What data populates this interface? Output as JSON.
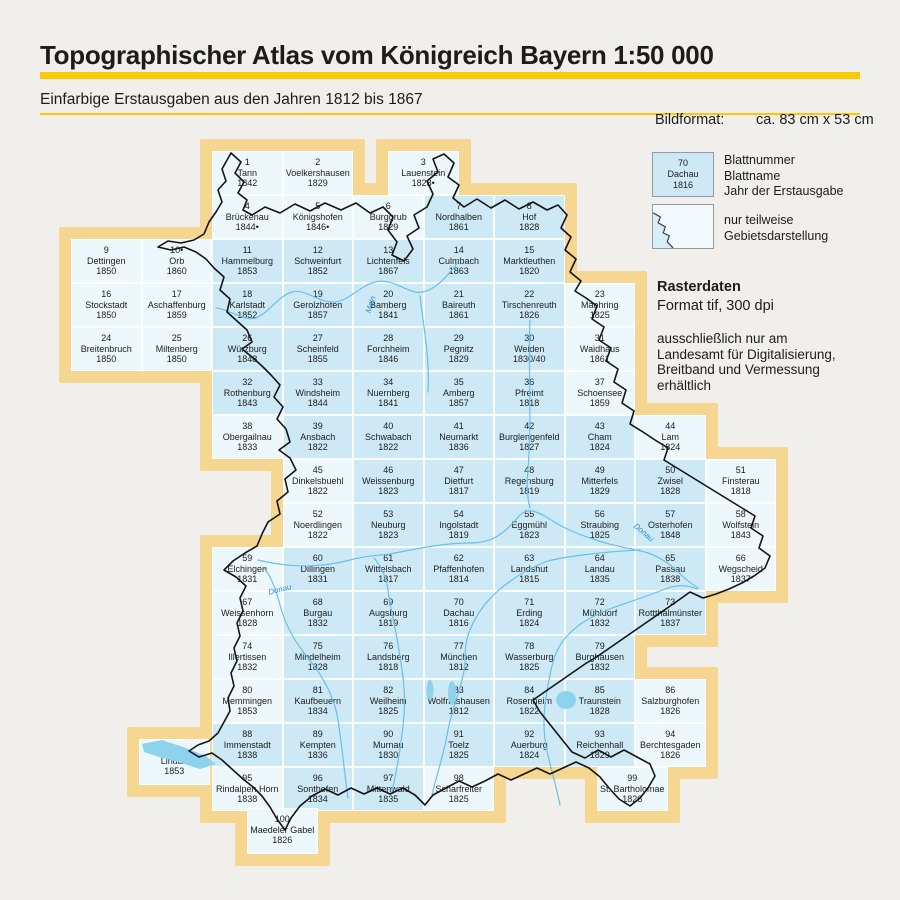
{
  "header": {
    "title": "Topographischer Atlas vom Königreich Bayern 1:50 000",
    "subtitle": "Einfarbige Erstausgaben aus den Jahren 1812 bis 1867"
  },
  "legend": {
    "bildformat_label": "Bildformat:",
    "bildformat_value": "ca. 83 cm x 53 cm",
    "sample": {
      "number": "70",
      "name": "Dachau",
      "year": "1816"
    },
    "sample_caption": "Blattnummer\nBlattname\nJahr der Erstausgabe",
    "partial_caption": "nur teilweise\nGebietsdarstellung",
    "raster_title": "Rasterdaten",
    "raster_format": "Format tif, 300 dpi",
    "raster_note": "ausschließlich nur am\nLandesamt für Digitalisierung,\nBreitband und Vermessung\nerhältlich"
  },
  "colors": {
    "accent_yellow": "#fbc801",
    "map_frame": "#f6d792",
    "sheet_full": "#cde9f6",
    "sheet_partial": "#edf8fd",
    "river": "#6bbfe9",
    "boundary": "#141414",
    "background": "#f1efeb"
  },
  "map": {
    "river_labels": [
      {
        "text": "Main",
        "x": 362,
        "y": 300,
        "rot": -72
      },
      {
        "text": "Donau",
        "x": 268,
        "y": 585,
        "rot": -14
      },
      {
        "text": "Donau",
        "x": 632,
        "y": 528,
        "rot": 40
      }
    ],
    "sheets": [
      {
        "n": "1",
        "name": "Tann",
        "year": "1842",
        "row": 1,
        "col": 3,
        "partial": true
      },
      {
        "n": "2",
        "name": "Voelkershausen",
        "year": "1829",
        "row": 1,
        "col": 4,
        "partial": true
      },
      {
        "n": "3",
        "name": "Lauenstein",
        "year": "1828•",
        "row": 1,
        "x": 388,
        "partial": true
      },
      {
        "n": "4",
        "name": "Brückenau",
        "year": "1844•",
        "row": 2,
        "col": 3,
        "partial": true
      },
      {
        "n": "5",
        "name": "Königshofen",
        "year": "1846•",
        "row": 2,
        "col": 4,
        "partial": true
      },
      {
        "n": "6",
        "name": "Burggrub",
        "year": "1829",
        "row": 2,
        "col": 5,
        "partial": true
      },
      {
        "n": "7",
        "name": "Nordhalben",
        "year": "1861",
        "row": 2,
        "col": 6,
        "partial": false
      },
      {
        "n": "8",
        "name": "Hof",
        "year": "1828",
        "row": 2,
        "col": 7,
        "partial": false
      },
      {
        "n": "9",
        "name": "Dettingen",
        "year": "1850",
        "row": 3,
        "col": 1,
        "partial": true
      },
      {
        "n": "10•",
        "name": "Orb",
        "year": "1860",
        "row": 3,
        "col": 2,
        "partial": true
      },
      {
        "n": "11",
        "name": "Hammelburg",
        "year": "1853",
        "row": 3,
        "col": 3,
        "partial": false
      },
      {
        "n": "12",
        "name": "Schweinfurt",
        "year": "1852",
        "row": 3,
        "col": 4,
        "partial": false
      },
      {
        "n": "13",
        "name": "Lichtenfels",
        "year": "1867",
        "row": 3,
        "col": 5,
        "partial": false
      },
      {
        "n": "14",
        "name": "Culmbach",
        "year": "1863",
        "row": 3,
        "col": 6,
        "partial": false
      },
      {
        "n": "15",
        "name": "Marktleuthen",
        "year": "1820",
        "row": 3,
        "col": 7,
        "partial": false
      },
      {
        "n": "16",
        "name": "Stockstadt",
        "year": "1850",
        "row": 4,
        "col": 1,
        "partial": true
      },
      {
        "n": "17",
        "name": "Aschaffenburg",
        "year": "1859",
        "row": 4,
        "col": 2,
        "partial": true
      },
      {
        "n": "18",
        "name": "Karlstadt",
        "year": "1852",
        "row": 4,
        "col": 3,
        "partial": false
      },
      {
        "n": "19",
        "name": "Gerolzhofen",
        "year": "1857",
        "row": 4,
        "col": 4,
        "partial": false
      },
      {
        "n": "20",
        "name": "Bamberg",
        "year": "1841",
        "row": 4,
        "col": 5,
        "partial": false
      },
      {
        "n": "21",
        "name": "Baireuth",
        "year": "1861",
        "row": 4,
        "col": 6,
        "partial": false
      },
      {
        "n": "22",
        "name": "Tirschenreuth",
        "year": "1826",
        "row": 4,
        "col": 7,
        "partial": false
      },
      {
        "n": "23",
        "name": "Maehring",
        "year": "1825",
        "row": 4,
        "col": 8,
        "partial": true
      },
      {
        "n": "24",
        "name": "Breitenbruch",
        "year": "1850",
        "row": 5,
        "col": 1,
        "partial": true
      },
      {
        "n": "25",
        "name": "Miltenberg",
        "year": "1850",
        "row": 5,
        "col": 2,
        "partial": true
      },
      {
        "n": "26",
        "name": "Würzburg",
        "year": "1848",
        "row": 5,
        "col": 3,
        "partial": false
      },
      {
        "n": "27",
        "name": "Scheinfeld",
        "year": "1855",
        "row": 5,
        "col": 4,
        "partial": false
      },
      {
        "n": "28",
        "name": "Forchheim",
        "year": "1846",
        "row": 5,
        "col": 5,
        "partial": false
      },
      {
        "n": "29",
        "name": "Pegnitz",
        "year": "1829",
        "row": 5,
        "col": 6,
        "partial": false
      },
      {
        "n": "30",
        "name": "Weiden",
        "year": "1830/40",
        "row": 5,
        "col": 7,
        "partial": false
      },
      {
        "n": "31",
        "name": "Waidhaus",
        "year": "1861",
        "row": 5,
        "col": 8,
        "partial": true
      },
      {
        "n": "32",
        "name": "Rothenburg",
        "year": "1843",
        "row": 6,
        "col": 3,
        "partial": false
      },
      {
        "n": "33",
        "name": "Windsheim",
        "year": "1844",
        "row": 6,
        "col": 4,
        "partial": false
      },
      {
        "n": "34",
        "name": "Nuernberg",
        "year": "1841",
        "row": 6,
        "col": 5,
        "partial": false
      },
      {
        "n": "35",
        "name": "Amberg",
        "year": "1857",
        "row": 6,
        "col": 6,
        "partial": false
      },
      {
        "n": "36",
        "name": "Pfreimt",
        "year": "1818",
        "row": 6,
        "col": 7,
        "partial": false
      },
      {
        "n": "37",
        "name": "Schoensee",
        "year": "1859",
        "row": 6,
        "col": 8,
        "partial": true
      },
      {
        "n": "38",
        "name": "Obergailnau",
        "year": "1833",
        "row": 7,
        "col": 3,
        "partial": true
      },
      {
        "n": "39",
        "name": "Ansbach",
        "year": "1822",
        "row": 7,
        "col": 4,
        "partial": false
      },
      {
        "n": "40",
        "name": "Schwabach",
        "year": "1822",
        "row": 7,
        "col": 5,
        "partial": false
      },
      {
        "n": "41",
        "name": "Neumarkt",
        "year": "1836",
        "row": 7,
        "col": 6,
        "partial": false
      },
      {
        "n": "42",
        "name": "Burglengenfeld",
        "year": "1827",
        "row": 7,
        "col": 7,
        "partial": false
      },
      {
        "n": "43",
        "name": "Cham",
        "year": "1824",
        "row": 7,
        "col": 8,
        "partial": false
      },
      {
        "n": "44",
        "name": "Lam",
        "year": "1824",
        "row": 7,
        "col": 9,
        "partial": true
      },
      {
        "n": "45",
        "name": "Dinkelsbuehl",
        "year": "1822",
        "row": 8,
        "col": 4,
        "partial": true
      },
      {
        "n": "46",
        "name": "Weissenburg",
        "year": "1823",
        "row": 8,
        "col": 5,
        "partial": false
      },
      {
        "n": "47",
        "name": "Dietfurt",
        "year": "1817",
        "row": 8,
        "col": 6,
        "partial": false
      },
      {
        "n": "48",
        "name": "Regensburg",
        "year": "1819",
        "row": 8,
        "col": 7,
        "partial": false
      },
      {
        "n": "49",
        "name": "Mitterfels",
        "year": "1829",
        "row": 8,
        "col": 8,
        "partial": false
      },
      {
        "n": "50",
        "name": "Zwisel",
        "year": "1828",
        "row": 8,
        "col": 9,
        "partial": false
      },
      {
        "n": "51",
        "name": "Finsterau",
        "year": "1818",
        "row": 8,
        "col": 10,
        "partial": true
      },
      {
        "n": "52",
        "name": "Noerdlingen",
        "year": "1822",
        "row": 9,
        "col": 4,
        "partial": true
      },
      {
        "n": "53",
        "name": "Neuburg",
        "year": "1823",
        "row": 9,
        "col": 5,
        "partial": false
      },
      {
        "n": "54",
        "name": "Ingolstadt",
        "year": "1819",
        "row": 9,
        "col": 6,
        "partial": false
      },
      {
        "n": "55",
        "name": "Eggmühl",
        "year": "1823",
        "row": 9,
        "col": 7,
        "partial": false
      },
      {
        "n": "56",
        "name": "Straubing",
        "year": "1825",
        "row": 9,
        "col": 8,
        "partial": false
      },
      {
        "n": "57",
        "name": "Osterhofen",
        "year": "1848",
        "row": 9,
        "col": 9,
        "partial": false
      },
      {
        "n": "58",
        "name": "Wolfstein",
        "year": "1843",
        "row": 9,
        "col": 10,
        "partial": true
      },
      {
        "n": "59",
        "name": "Elchingen",
        "year": "1831",
        "row": 10,
        "col": 3,
        "partial": true
      },
      {
        "n": "60",
        "name": "Dillingen",
        "year": "1831",
        "row": 10,
        "col": 4,
        "partial": false
      },
      {
        "n": "61",
        "name": "Wittelsbach",
        "year": "1817",
        "row": 10,
        "col": 5,
        "partial": false
      },
      {
        "n": "62",
        "name": "Pfaffenhofen",
        "year": "1814",
        "row": 10,
        "col": 6,
        "partial": false
      },
      {
        "n": "63",
        "name": "Landshut",
        "year": "1815",
        "row": 10,
        "col": 7,
        "partial": false
      },
      {
        "n": "64",
        "name": "Landau",
        "year": "1835",
        "row": 10,
        "col": 8,
        "partial": false
      },
      {
        "n": "65",
        "name": "Passau",
        "year": "1838",
        "row": 10,
        "col": 9,
        "partial": false
      },
      {
        "n": "66",
        "name": "Wegscheid",
        "year": "1837",
        "row": 10,
        "col": 10,
        "partial": true
      },
      {
        "n": "67",
        "name": "Weissenhorn",
        "year": "1828",
        "row": 11,
        "col": 3,
        "partial": true
      },
      {
        "n": "68",
        "name": "Burgau",
        "year": "1832",
        "row": 11,
        "col": 4,
        "partial": false
      },
      {
        "n": "69",
        "name": "Augsburg",
        "year": "1819",
        "row": 11,
        "col": 5,
        "partial": false
      },
      {
        "n": "70",
        "name": "Dachau",
        "year": "1816",
        "row": 11,
        "col": 6,
        "partial": false
      },
      {
        "n": "71",
        "name": "Erding",
        "year": "1824",
        "row": 11,
        "col": 7,
        "partial": false
      },
      {
        "n": "72",
        "name": "Mühldorf",
        "year": "1832",
        "row": 11,
        "col": 8,
        "partial": false
      },
      {
        "n": "73",
        "name": "Rottthalmünster",
        "year": "1837",
        "row": 11,
        "col": 9,
        "partial": false
      },
      {
        "n": "74",
        "name": "Illertissen",
        "year": "1832",
        "row": 12,
        "col": 3,
        "partial": true
      },
      {
        "n": "75",
        "name": "Mindelheim",
        "year": "1828",
        "row": 12,
        "col": 4,
        "partial": false
      },
      {
        "n": "76",
        "name": "Landsberg",
        "year": "1818",
        "row": 12,
        "col": 5,
        "partial": false
      },
      {
        "n": "77",
        "name": "München",
        "year": "1812",
        "row": 12,
        "col": 6,
        "partial": false
      },
      {
        "n": "78",
        "name": "Wasserburg",
        "year": "1825",
        "row": 12,
        "col": 7,
        "partial": false
      },
      {
        "n": "79",
        "name": "Burghausen",
        "year": "1832",
        "row": 12,
        "col": 8,
        "partial": false
      },
      {
        "n": "80",
        "name": "Memmingen",
        "year": "1853",
        "row": 13,
        "col": 3,
        "partial": true
      },
      {
        "n": "81",
        "name": "Kaufbeuern",
        "year": "1834",
        "row": 13,
        "col": 4,
        "partial": false
      },
      {
        "n": "82",
        "name": "Weilheim",
        "year": "1825",
        "row": 13,
        "col": 5,
        "partial": false
      },
      {
        "n": "83",
        "name": "Wolfratshausen",
        "year": "1812",
        "row": 13,
        "col": 6,
        "partial": false
      },
      {
        "n": "84",
        "name": "Rosenheim",
        "year": "1822",
        "row": 13,
        "col": 7,
        "partial": false
      },
      {
        "n": "85",
        "name": "Traunstein",
        "year": "1828",
        "row": 13,
        "col": 8,
        "partial": false
      },
      {
        "n": "86",
        "name": "Salzburghofen",
        "year": "1826",
        "row": 13,
        "col": 9,
        "partial": true
      },
      {
        "n": "87",
        "name": "Lindau",
        "year": "1853",
        "x": 139,
        "y": 739,
        "h": 46,
        "partial": true
      },
      {
        "n": "88",
        "name": "Immenstadt",
        "year": "1838",
        "row": 14,
        "col": 3,
        "partial": false
      },
      {
        "n": "89",
        "name": "Kempten",
        "year": "1836",
        "row": 14,
        "col": 4,
        "partial": false
      },
      {
        "n": "90",
        "name": "Murnau",
        "year": "1830",
        "row": 14,
        "col": 5,
        "partial": false
      },
      {
        "n": "91",
        "name": "Toelz",
        "year": "1825",
        "row": 14,
        "col": 6,
        "partial": false
      },
      {
        "n": "92",
        "name": "Auerburg",
        "year": "1824",
        "row": 14,
        "col": 7,
        "partial": false
      },
      {
        "n": "93",
        "name": "Reichenhall",
        "year": "1829",
        "row": 14,
        "col": 8,
        "partial": false
      },
      {
        "n": "94",
        "name": "Berchtesgaden",
        "year": "1826",
        "row": 14,
        "col": 9,
        "partial": true
      },
      {
        "n": "95",
        "name": "Rindalpen Horn",
        "year": "1838",
        "row": 15,
        "col": 3,
        "partial": true
      },
      {
        "n": "96",
        "name": "Sonthofen",
        "year": "1834",
        "row": 15,
        "col": 4,
        "partial": false
      },
      {
        "n": "97",
        "name": "Mittenwald",
        "year": "1835",
        "row": 15,
        "col": 5,
        "partial": false
      },
      {
        "n": "98",
        "name": "Scharfreiter",
        "year": "1825",
        "row": 15,
        "col": 6,
        "partial": true
      },
      {
        "n": "99",
        "name": "St. Bartholomae",
        "year": "1826",
        "row": 15,
        "x": 597,
        "partial": true
      },
      {
        "n": "100",
        "name": "Maedeler Gabel",
        "year": "1826",
        "x": 247,
        "y": 808,
        "h": 46,
        "partial": true
      }
    ]
  }
}
